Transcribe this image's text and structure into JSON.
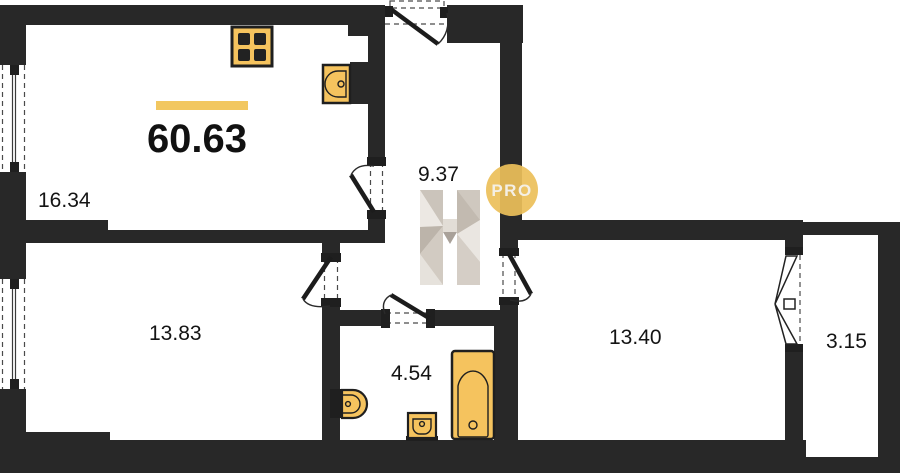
{
  "plan": {
    "total_area_label": "60.63",
    "rooms": {
      "living_kitchen": {
        "area": "16.34"
      },
      "hallway": {
        "area": "9.37"
      },
      "bedroom_left": {
        "area": "13.83"
      },
      "bathroom": {
        "area": "4.54"
      },
      "bedroom_right": {
        "area": "13.40"
      },
      "balcony": {
        "area": "3.15"
      }
    },
    "watermark": {
      "letter": "H",
      "badge": "PRO"
    },
    "fixtures": {
      "stove": "stove",
      "kitchen_sink": "kitchen-sink",
      "toilet": "toilet",
      "washbasin": "washbasin",
      "bathtub": "bathtub"
    },
    "colors": {
      "wall": "#282828",
      "accent_bar": "#F2C760",
      "fixture_fill": "#F5C35E",
      "badge_yellow": "#ECC05A",
      "watermark_light": "#ECE8E3",
      "watermark_mid": "#D5CEC6",
      "watermark_dark": "#A9A199"
    }
  }
}
